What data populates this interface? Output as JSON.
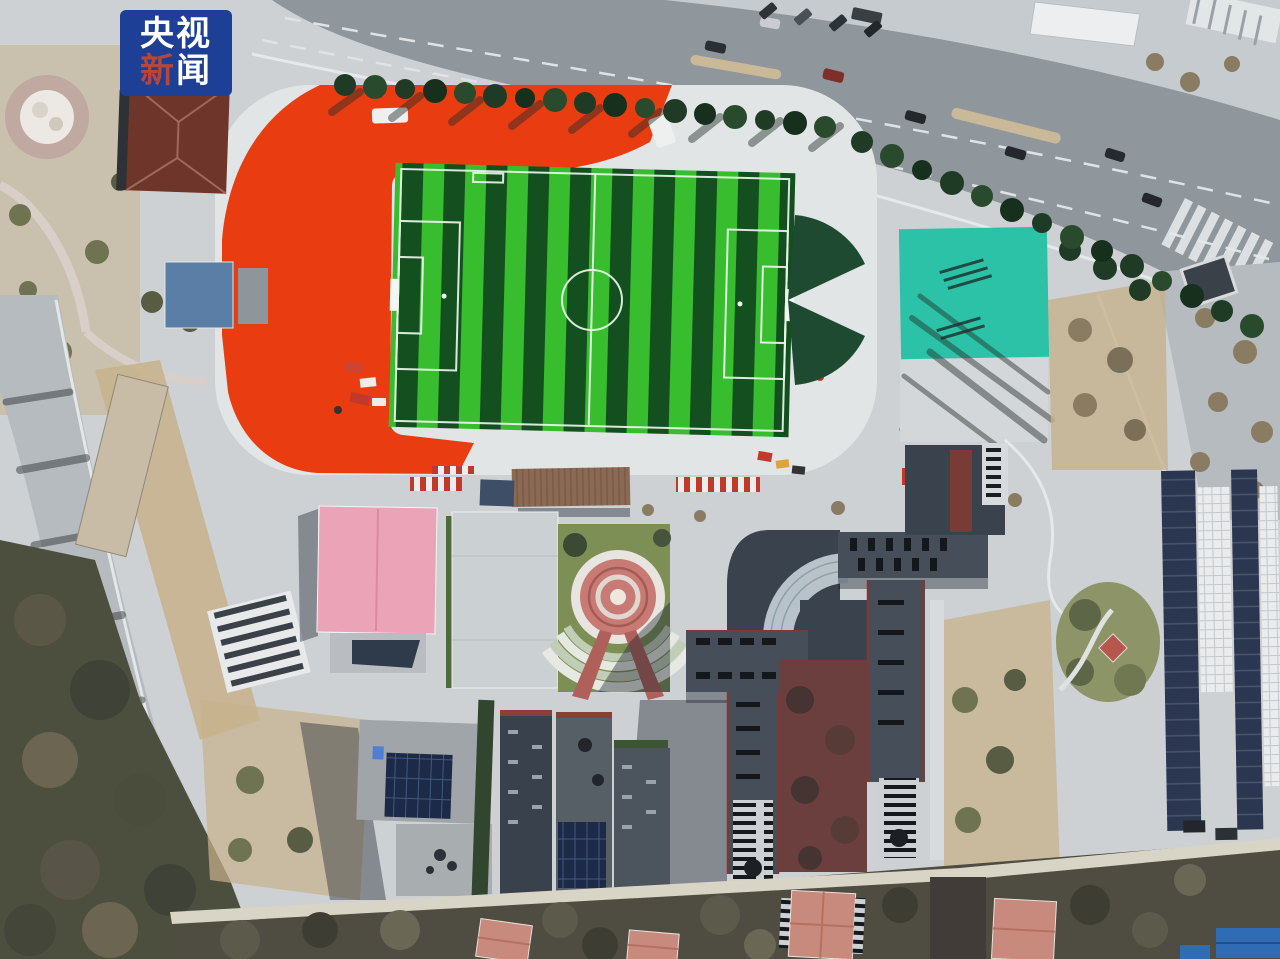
{
  "watermark": {
    "line1": "央视",
    "line2_accent": "新",
    "line2_rest": "闻",
    "colors_note": "CCTV News logo watermark"
  },
  "scene": {
    "colors": {
      "ground": "#cdd1d4",
      "road": "#8f969c",
      "left_road": "#b6bbbf",
      "sidewalk": "#c6cbcf",
      "track_red": "#e93d11",
      "track_white": "#e2e5e6",
      "pitch_light": "#38bd2f",
      "pitch_dark": "#14501f",
      "court_teal": "#2bc2a7",
      "court_apron": "#d3d7d9",
      "wedge_green": "#1d4a30",
      "lawn_green": "#7e8f55",
      "plaza_red": "#c77b74",
      "roof_pink": "#eba3b7",
      "roof_brown": "#6e352b",
      "roof_blue": "#5a7ea6",
      "roof_slate": "#454e59",
      "roof_slate_dark": "#3a424d",
      "courtyard_red": "#6b3f3d",
      "stair_gray": "#cdd0d2",
      "solar_navy": "#1c2947",
      "greenhouse_dark": "#2b3650",
      "greenhouse_white": "#e9ebec",
      "roof_salmon": "#c98a7e",
      "roof_blue_bright": "#2f6cb3",
      "dry_grass": "#c7b28c",
      "tree_dark": "#1f3b26",
      "tree_olive": "#6f7352",
      "tree_bare": "#8a7b63",
      "wall_path": "#d8d4c6",
      "maroon": "#7a3b36",
      "canopy_brown": "#8a6a55",
      "building_gray": "#9fa5a8",
      "wm_blue": "#1d3f96",
      "wm_accent": "#b5473a",
      "wm_text": "#ffffff"
    }
  }
}
